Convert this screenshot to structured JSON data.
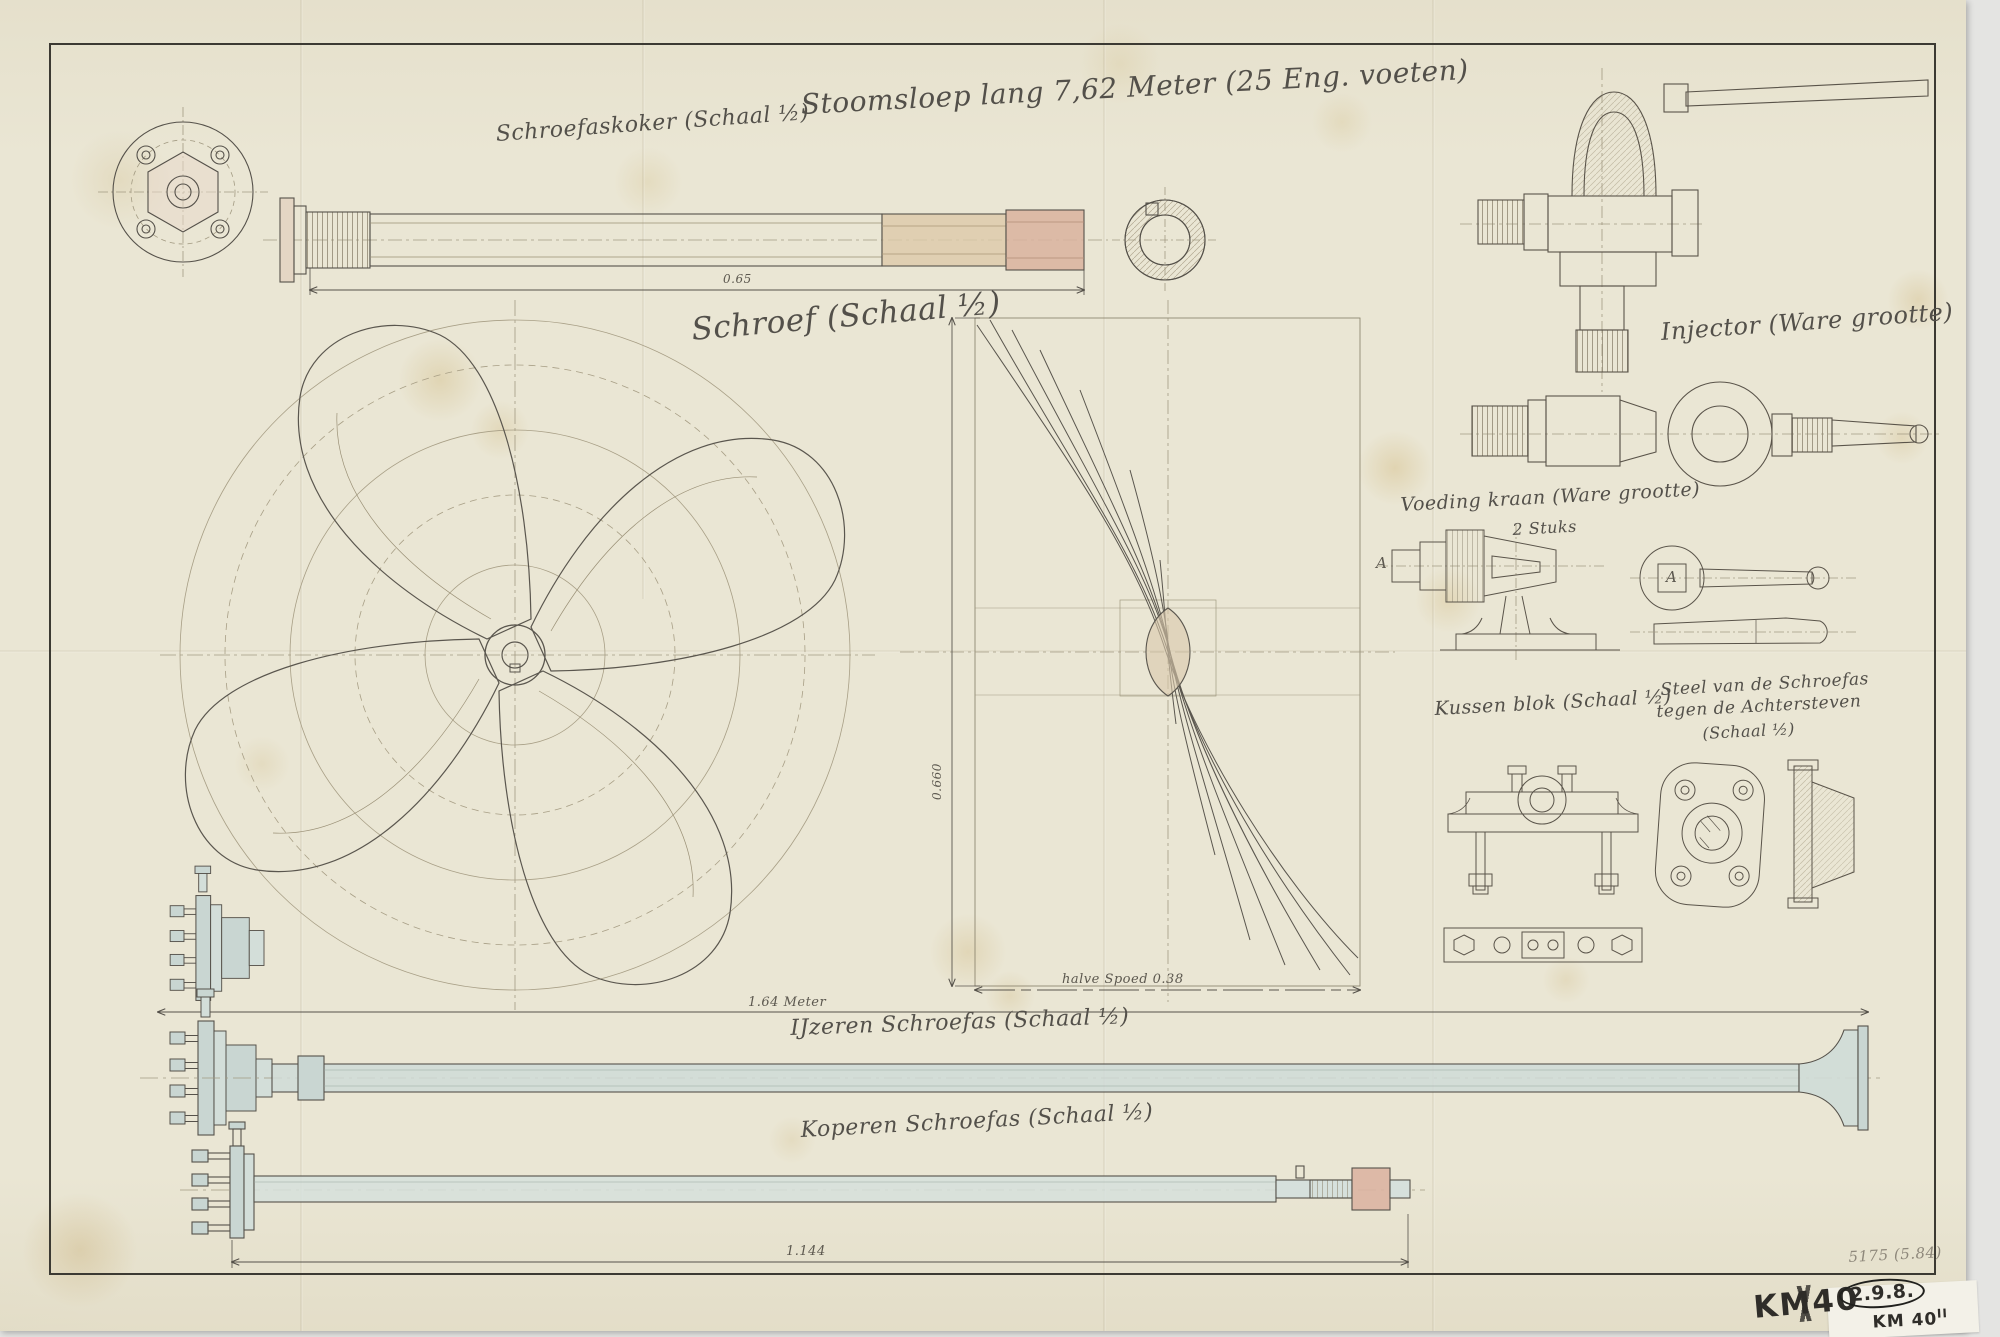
{
  "title": {
    "text": "Stoomsloep lang 7,62 Meter (25 Eng. voeten)"
  },
  "labels": {
    "schroefaskoker": "Schroefaskoker (Schaal ½)",
    "schroef": "Schroef (Schaal ½)",
    "injector": "Injector (Ware grootte)",
    "voeding_line1": "Voeding kraan (Ware grootte)",
    "voeding_line2": "2 Stuks",
    "kussenblok": "Kussen blok (Schaal ½)",
    "steel_line1": "Steel van de Schroefas",
    "steel_line2": "tegen de Achtersteven",
    "steel_line3": "(Schaal ½)",
    "ijzeren_schroefas": "IJzeren Schroefas (Schaal ½)",
    "koperen_schroefas": "Koperen Schroefas (Schaal ½)"
  },
  "dimensions": {
    "koker_length": "0.65",
    "schroef_diameter": "0.660",
    "halve_spoed": "halve Spoed 0.38",
    "ijzeren_length": "1.64 Meter",
    "koperen_length": "1.144",
    "marker_a_section": "A",
    "marker_a_handle": "A"
  },
  "annotations": {
    "pencil_ref": "5175 (5.84)",
    "km40_crossed": "KM40",
    "circled_ref": "2.9.8.",
    "sticker_ref": "KM 40",
    "sticker_sup": "II"
  },
  "colors": {
    "paper": "#eae6d4",
    "ink": "#55514a",
    "tint_blue": "#c9d6d2",
    "tint_tan": "#ddc9a9",
    "tint_pink": "#d9b29d"
  }
}
